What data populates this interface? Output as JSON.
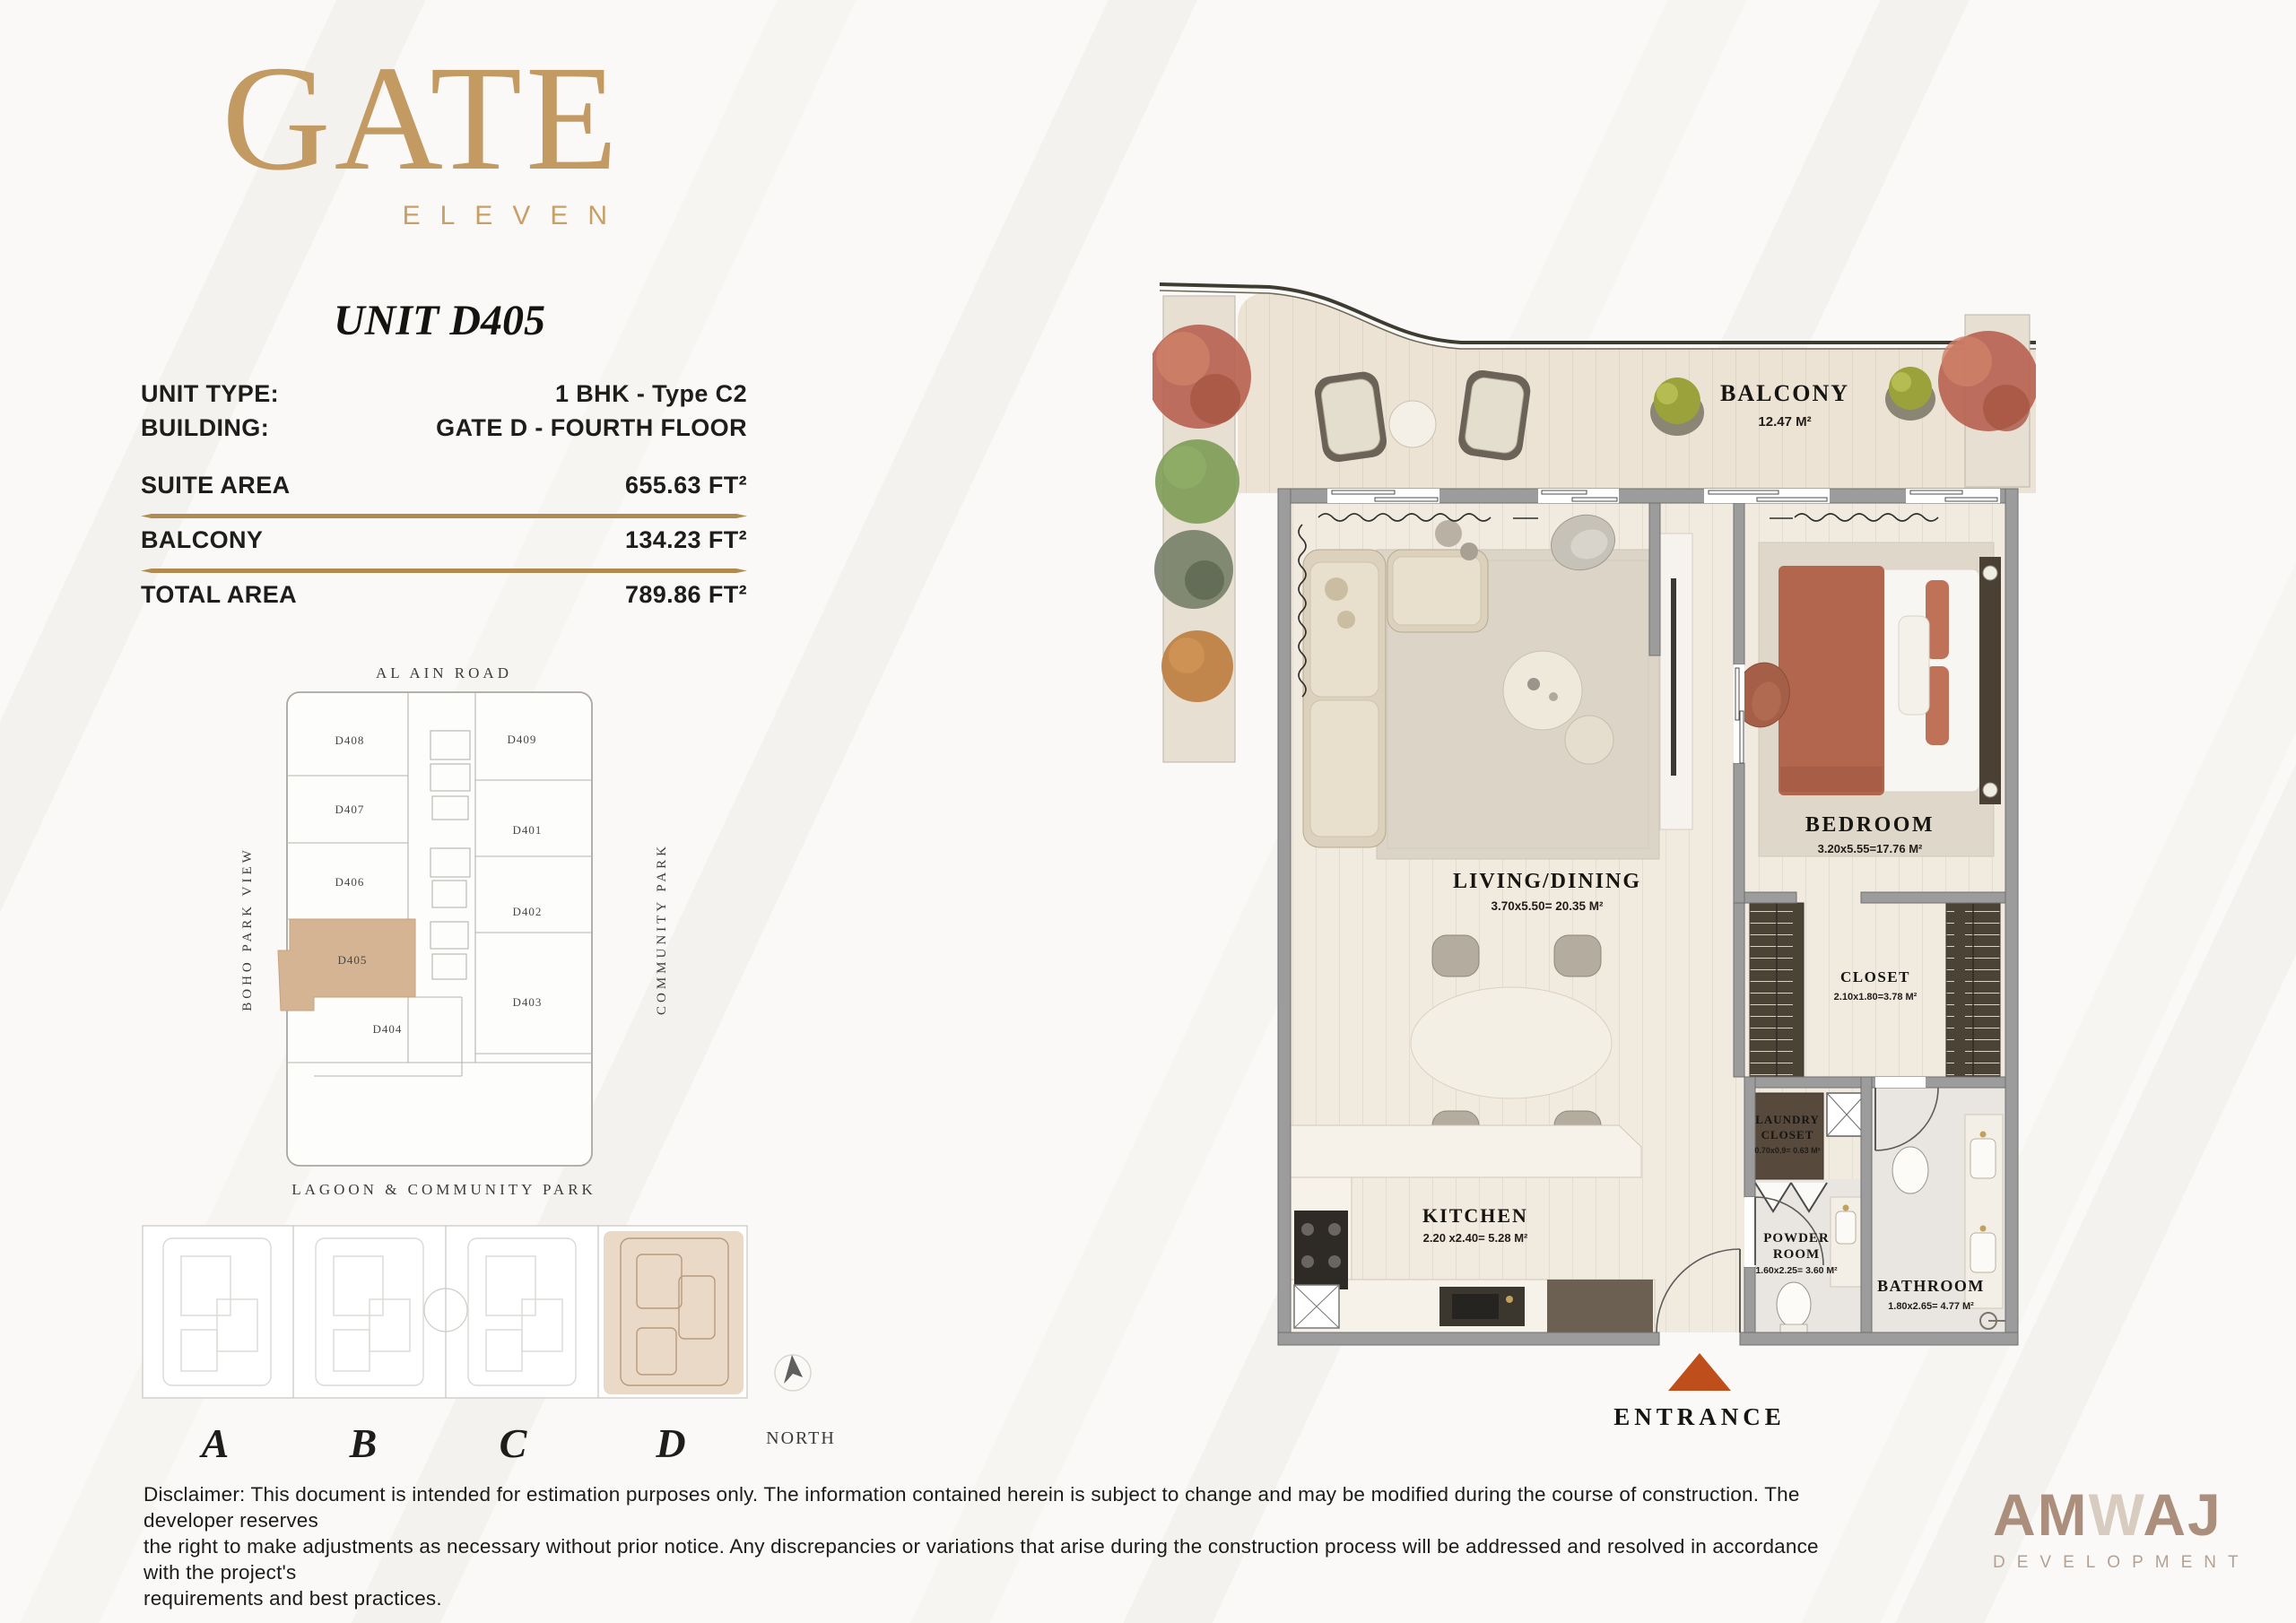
{
  "brand": {
    "name": "GATE",
    "subtitle": "ELEVEN"
  },
  "unit_title": "UNIT D405",
  "info": {
    "type_label": "UNIT TYPE:",
    "type_value": "1 BHK - Type C2",
    "building_label": "BUILDING:",
    "building_value": "GATE D - FOURTH FLOOR",
    "suite_label": "SUITE AREA",
    "suite_value": "655.63 FT²",
    "balcony_label": "BALCONY",
    "balcony_value": "134.23 FT²",
    "total_label": "TOTAL AREA",
    "total_value": "789.86 FT²"
  },
  "keyplan": {
    "road_top": "AL AIN ROAD",
    "road_left": "BOHO PARK VIEW",
    "road_right": "COMMUNITY PARK",
    "road_bottom": "LAGOON & COMMUNITY PARK",
    "units": {
      "d408": "D408",
      "d409": "D409",
      "d407": "D407",
      "d401": "D401",
      "d406": "D406",
      "d402": "D402",
      "d405": "D405",
      "d403": "D403",
      "d404": "D404"
    },
    "highlighted_unit": "D405",
    "highlight_color": "#d5b493"
  },
  "selector": {
    "a": "A",
    "b": "B",
    "c": "C",
    "d": "D",
    "active": "D",
    "north_label": "NORTH"
  },
  "plan": {
    "balcony": {
      "name": "BALCONY",
      "dims": "12.47 M²"
    },
    "living": {
      "name": "LIVING/DINING",
      "dims": "3.70x5.50= 20.35 M²"
    },
    "bedroom": {
      "name": "BEDROOM",
      "dims": "3.20x5.55=17.76 M²"
    },
    "closet": {
      "name": "CLOSET",
      "dims": "2.10x1.80=3.78 M²"
    },
    "laundry": {
      "line1": "LAUNDRY",
      "line2": "CLOSET",
      "dims": "0.70x0.9= 0.63 M²"
    },
    "kitchen": {
      "name": "KITCHEN",
      "dims": "2.20 x2.40= 5.28 M²"
    },
    "powder": {
      "line1": "POWDER",
      "line2": "ROOM",
      "dims": "1.60x2.25= 3.60 M²"
    },
    "bathroom": {
      "name": "BATHROOM",
      "dims": "1.80x2.65= 4.77 M²"
    },
    "entrance_label": "ENTRANCE"
  },
  "disclaimer": {
    "line1": "Disclaimer: This document is intended for estimation purposes only. The information contained herein is subject to change and may be modified during the course of construction. The developer reserves",
    "line2": "the right to make adjustments as necessary without prior notice. Any discrepancies or variations that arise during the construction process will be addressed and resolved in accordance with the project's",
    "line3": "requirements and best practices."
  },
  "developer": {
    "part1": "AM",
    "part2": "W",
    "part3": "AJ",
    "subtitle": "DEVELOPMENT"
  },
  "colors": {
    "gold": "#c49a63",
    "accent_tan": "#d5b493",
    "entrance_arrow": "#bf4e1d",
    "developer_taupe": "#ab8f7c"
  }
}
